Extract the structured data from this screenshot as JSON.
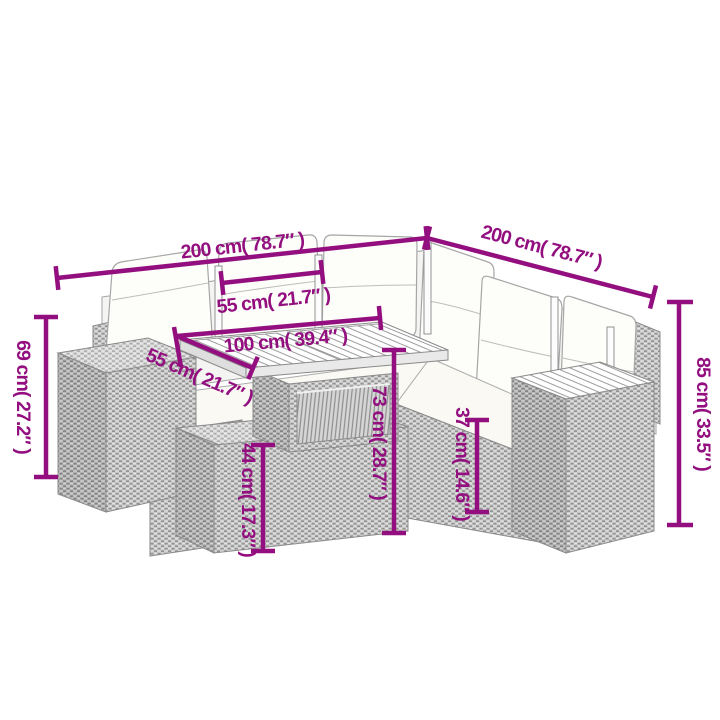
{
  "diagram": {
    "type": "product-dimension-diagram",
    "product_name": "6 Piece Garden Sofa Set with Cushions Grey Poly Rattan",
    "background_color": "#ffffff",
    "accent_color": "#930F7F",
    "labels": {
      "sofa_left_side_length": "200 cm( 78.7″ )",
      "sofa_right_side_length": "200 cm( 78.7″ )",
      "seat_section_width": "55 cm( 21.7″ )",
      "table_length": "100 cm( 39.4″ )",
      "table_width": "55 cm( 21.7″ )",
      "ottoman_height": "69 cm( 27.2″ )",
      "total_height": "85 cm( 33.5″ )",
      "table_height": "73 cm( 28.7″ )",
      "table_base_height": "44 cm( 17.3″ )",
      "seat_height": "37 cm( 14.6″ )"
    },
    "dimensions_cm": {
      "sofa_left_side_length": 200,
      "sofa_right_side_length": 200,
      "seat_section_width": 55,
      "table_length": 100,
      "table_width": 55,
      "ottoman_height": 69,
      "total_height": 85,
      "table_height": 73,
      "table_base_height": 44,
      "seat_height": 37
    }
  }
}
